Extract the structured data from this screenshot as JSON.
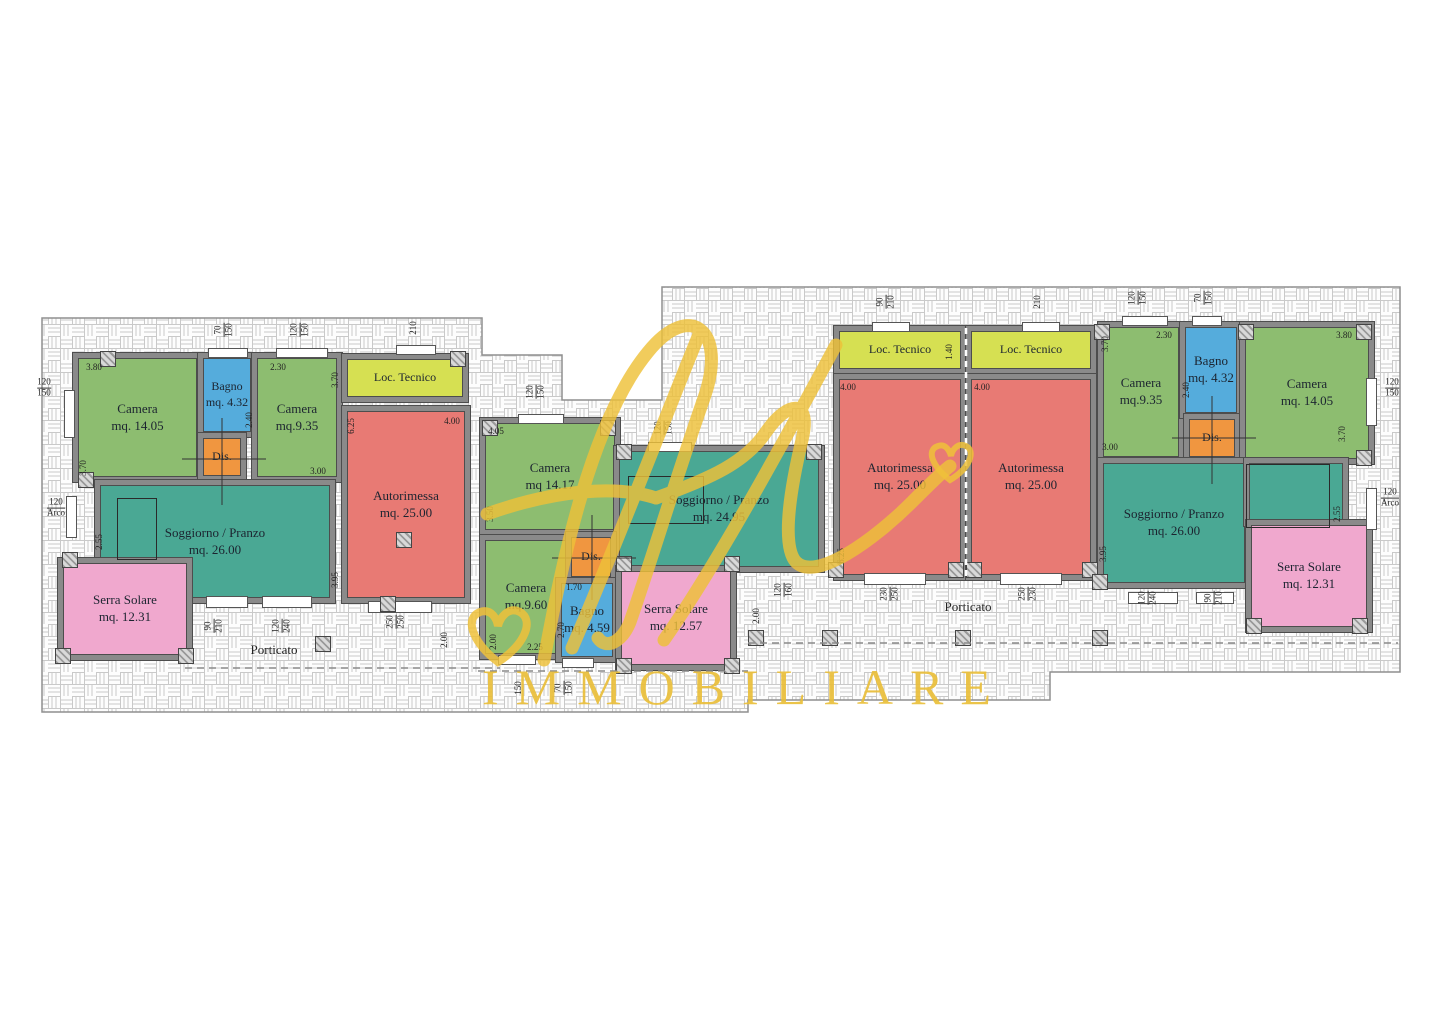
{
  "watermark": {
    "script": "fl",
    "brand": "IMMOBILIARE",
    "gold": "#eabf3a"
  },
  "palette": {
    "wall": "#8a8a8a",
    "wall_edge": "#4d4d4d",
    "camera_green": "#8dbd70",
    "bagno_blue": "#55acdc",
    "dis_orange": "#f09640",
    "loc_tecnico_yellow": "#d6e052",
    "autorimessa_red": "#e87a74",
    "soggiorno_teal": "#4aa894",
    "serra_pink": "#f0a8ce",
    "paving_line": "#c9c9c9",
    "dim_text": "#222222"
  },
  "floorplan": {
    "rooms": [
      {
        "id": "camera-a1",
        "c": "camera_green",
        "x": 73,
        "y": 353,
        "w": 129,
        "h": 129,
        "label": [
          "Camera",
          "mq. 14.05"
        ]
      },
      {
        "id": "bagno-a",
        "c": "bagno_blue",
        "x": 198,
        "y": 353,
        "w": 58,
        "h": 84,
        "label": [
          "Bagno",
          "mq. 4.32"
        ]
      },
      {
        "id": "camera-a2",
        "c": "camera_green",
        "x": 252,
        "y": 353,
        "w": 90,
        "h": 129,
        "label": [
          "Camera",
          "mq.9.35"
        ]
      },
      {
        "id": "dis-a",
        "c": "dis_orange",
        "x": 198,
        "y": 433,
        "w": 48,
        "h": 48,
        "label": [
          "Dis."
        ]
      },
      {
        "id": "loc-tecnico-a",
        "c": "loc_tecnico_yellow",
        "x": 342,
        "y": 354,
        "w": 126,
        "h": 48,
        "label": [
          "Loc. Tecnico"
        ]
      },
      {
        "id": "autorimessa-a",
        "c": "autorimessa_red",
        "x": 342,
        "y": 406,
        "w": 128,
        "h": 197,
        "label": [
          "Autorimessa",
          "mq. 25.00"
        ]
      },
      {
        "id": "soggiorno-a",
        "c": "soggiorno_teal",
        "x": 95,
        "y": 480,
        "w": 240,
        "h": 123,
        "label": [
          "Soggiorno / Pranzo",
          "mq. 26.00"
        ]
      },
      {
        "id": "serra-solare-a",
        "c": "serra_pink",
        "x": 58,
        "y": 558,
        "w": 134,
        "h": 102,
        "label": [
          "Serra Solare",
          "mq. 12.31"
        ]
      },
      {
        "id": "camera-b1",
        "c": "camera_green",
        "x": 480,
        "y": 418,
        "w": 140,
        "h": 117,
        "label": [
          "Camera",
          "mq 14.17"
        ]
      },
      {
        "id": "camera-b2",
        "c": "camera_green",
        "x": 480,
        "y": 535,
        "w": 92,
        "h": 124,
        "label": [
          "Camera",
          "mq.9.60"
        ]
      },
      {
        "id": "soggiorno-b",
        "c": "soggiorno_teal",
        "x": 614,
        "y": 446,
        "w": 210,
        "h": 126,
        "label": [
          "Soggiorno / Pranzo",
          "mq. 24.95"
        ]
      },
      {
        "id": "dis-b",
        "c": "dis_orange",
        "x": 566,
        "y": 532,
        "w": 50,
        "h": 50,
        "label": [
          "Dis."
        ]
      },
      {
        "id": "bagno-b",
        "c": "bagno_blue",
        "x": 556,
        "y": 578,
        "w": 62,
        "h": 84,
        "label": [
          "Bagno",
          "mq. 4.59"
        ]
      },
      {
        "id": "serra-solare-b",
        "c": "serra_pink",
        "x": 616,
        "y": 566,
        "w": 120,
        "h": 104,
        "label": [
          "Serra Solare",
          "mq. 12.57"
        ]
      },
      {
        "id": "loc-tecnico-c",
        "c": "loc_tecnico_yellow",
        "x": 834,
        "y": 326,
        "w": 132,
        "h": 48,
        "label": [
          "Loc. Tecnico"
        ]
      },
      {
        "id": "loc-tecnico-d",
        "c": "loc_tecnico_yellow",
        "x": 966,
        "y": 326,
        "w": 130,
        "h": 48,
        "label": [
          "Loc. Tecnico"
        ]
      },
      {
        "id": "autorimessa-c",
        "c": "autorimessa_red",
        "x": 834,
        "y": 374,
        "w": 132,
        "h": 206,
        "label": [
          "Autorimessa",
          "mq. 25.00"
        ]
      },
      {
        "id": "autorimessa-d",
        "c": "autorimessa_red",
        "x": 966,
        "y": 374,
        "w": 130,
        "h": 206,
        "label": [
          "Autorimessa",
          "mq. 25.00"
        ]
      },
      {
        "id": "camera-d1",
        "c": "camera_green",
        "x": 1098,
        "y": 322,
        "w": 86,
        "h": 140,
        "label": [
          "Camera",
          "mq.9.35"
        ]
      },
      {
        "id": "bagno-d",
        "c": "bagno_blue",
        "x": 1180,
        "y": 322,
        "w": 62,
        "h": 96,
        "label": [
          "Bagno",
          "mq. 4.32"
        ]
      },
      {
        "id": "dis-d",
        "c": "dis_orange",
        "x": 1184,
        "y": 414,
        "w": 56,
        "h": 48,
        "label": [
          "Dis."
        ]
      },
      {
        "id": "camera-d2",
        "c": "camera_green",
        "x": 1240,
        "y": 322,
        "w": 134,
        "h": 142,
        "label": [
          "Camera",
          "mq. 14.05"
        ]
      },
      {
        "id": "soggiorno-d",
        "c": "soggiorno_teal",
        "x": 1098,
        "y": 458,
        "w": 152,
        "h": 130,
        "label": [
          "Soggiorno / Pranzo",
          "mq. 26.00"
        ]
      },
      {
        "id": "soggiorno-d-ext",
        "c": "soggiorno_teal",
        "x": 1244,
        "y": 458,
        "w": 104,
        "h": 68,
        "label": []
      },
      {
        "id": "serra-solare-d",
        "c": "serra_pink",
        "x": 1246,
        "y": 520,
        "w": 126,
        "h": 112,
        "label": [
          "Serra Solare",
          "mq. 12.31"
        ]
      }
    ],
    "dims": [
      {
        "n": "70",
        "d": "150",
        "x": 224,
        "y": 330,
        "r": 1
      },
      {
        "n": "120",
        "d": "150",
        "x": 300,
        "y": 330,
        "r": 1
      },
      {
        "t": "210",
        "x": 414,
        "y": 328,
        "r": 1
      },
      {
        "n": "120",
        "d": "150",
        "x": 44,
        "y": 388
      },
      {
        "t": "3.80",
        "x": 94,
        "y": 368
      },
      {
        "t": "3.70",
        "x": 84,
        "y": 468,
        "r": 1
      },
      {
        "t": "2.30",
        "x": 278,
        "y": 368
      },
      {
        "t": "3.70",
        "x": 336,
        "y": 380,
        "r": 1
      },
      {
        "t": "2.40",
        "x": 250,
        "y": 420,
        "r": 1
      },
      {
        "t": "3.00",
        "x": 318,
        "y": 472
      },
      {
        "t": "6.25",
        "x": 352,
        "y": 426,
        "r": 1
      },
      {
        "t": "4.00",
        "x": 452,
        "y": 422
      },
      {
        "n": "120",
        "d": "Arco",
        "x": 56,
        "y": 508
      },
      {
        "t": "2.55",
        "x": 100,
        "y": 542,
        "r": 1
      },
      {
        "t": "3.95",
        "x": 336,
        "y": 580,
        "r": 1
      },
      {
        "n": "90",
        "d": "210",
        "x": 214,
        "y": 626,
        "r": 1
      },
      {
        "n": "120",
        "d": "240",
        "x": 282,
        "y": 626,
        "r": 1
      },
      {
        "n": "250",
        "d": "250",
        "x": 396,
        "y": 622,
        "r": 1
      },
      {
        "t": "2.00",
        "x": 445,
        "y": 640,
        "r": 1
      },
      {
        "t": "2.00",
        "x": 494,
        "y": 642,
        "r": 1
      },
      {
        "t": "150",
        "x": 519,
        "y": 688,
        "r": 1
      },
      {
        "n": "70",
        "d": "150",
        "x": 564,
        "y": 688,
        "r": 1
      },
      {
        "n": "120",
        "d": "150",
        "x": 536,
        "y": 392,
        "r": 1
      },
      {
        "t": "4.05",
        "x": 496,
        "y": 432
      },
      {
        "t": "3.50",
        "x": 491,
        "y": 514,
        "r": 1
      },
      {
        "n": "120",
        "d": "150",
        "x": 664,
        "y": 428,
        "r": 1
      },
      {
        "t": "1.70",
        "x": 574,
        "y": 588
      },
      {
        "t": "2.70",
        "x": 562,
        "y": 630,
        "r": 1
      },
      {
        "t": "2.25",
        "x": 535,
        "y": 648
      },
      {
        "n": "120",
        "d": "160",
        "x": 784,
        "y": 590,
        "r": 1
      },
      {
        "t": "2.00",
        "x": 757,
        "y": 616,
        "r": 1
      },
      {
        "n": "90",
        "d": "210",
        "x": 886,
        "y": 302,
        "r": 1
      },
      {
        "t": "210",
        "x": 1038,
        "y": 302,
        "r": 1
      },
      {
        "t": "1.40",
        "x": 950,
        "y": 352,
        "r": 1
      },
      {
        "t": "4.00",
        "x": 848,
        "y": 388
      },
      {
        "t": "4.00",
        "x": 982,
        "y": 388
      },
      {
        "t": "6.25",
        "x": 842,
        "y": 556,
        "r": 1
      },
      {
        "n": "120",
        "d": "150",
        "x": 1138,
        "y": 298,
        "r": 1
      },
      {
        "n": "70",
        "d": "150",
        "x": 1204,
        "y": 298,
        "r": 1
      },
      {
        "t": "3.70",
        "x": 1106,
        "y": 344,
        "r": 1
      },
      {
        "t": "2.30",
        "x": 1164,
        "y": 336
      },
      {
        "t": "3.80",
        "x": 1344,
        "y": 336
      },
      {
        "t": "2.40",
        "x": 1187,
        "y": 390,
        "r": 1
      },
      {
        "t": "3.00",
        "x": 1110,
        "y": 448
      },
      {
        "t": "3.70",
        "x": 1343,
        "y": 434,
        "r": 1
      },
      {
        "n": "120",
        "d": "150",
        "x": 1392,
        "y": 388
      },
      {
        "n": "120",
        "d": "Arco",
        "x": 1390,
        "y": 498
      },
      {
        "t": "2.55",
        "x": 1338,
        "y": 514,
        "r": 1
      },
      {
        "t": "3.95",
        "x": 1104,
        "y": 554,
        "r": 1
      },
      {
        "n": "230",
        "d": "250",
        "x": 890,
        "y": 594,
        "r": 1
      },
      {
        "n": "250",
        "d": "230",
        "x": 1028,
        "y": 594,
        "r": 1
      },
      {
        "n": "120",
        "d": "240",
        "x": 1148,
        "y": 598,
        "r": 1
      },
      {
        "n": "90",
        "d": "210",
        "x": 1214,
        "y": 598,
        "r": 1
      }
    ],
    "texts": [
      {
        "t": "Porticato",
        "x": 274,
        "y": 650
      },
      {
        "t": "Porticato",
        "x": 968,
        "y": 607
      }
    ],
    "openings": [
      [
        64,
        390,
        9,
        46
      ],
      [
        208,
        348,
        38,
        8
      ],
      [
        276,
        348,
        50,
        8
      ],
      [
        396,
        345,
        38,
        8
      ],
      [
        66,
        496,
        9,
        40
      ],
      [
        206,
        596,
        40,
        10
      ],
      [
        262,
        596,
        48,
        10
      ],
      [
        368,
        601,
        62,
        10
      ],
      [
        518,
        414,
        44,
        8
      ],
      [
        648,
        442,
        42,
        8
      ],
      [
        498,
        655,
        36,
        8
      ],
      [
        562,
        658,
        30,
        8
      ],
      [
        872,
        322,
        36,
        8
      ],
      [
        1022,
        322,
        36,
        8
      ],
      [
        1122,
        316,
        44,
        8
      ],
      [
        1192,
        316,
        28,
        8
      ],
      [
        864,
        573,
        60,
        10
      ],
      [
        1000,
        573,
        60,
        10
      ],
      [
        1366,
        378,
        9,
        46
      ],
      [
        1366,
        488,
        9,
        40
      ],
      [
        1128,
        592,
        48,
        10
      ],
      [
        1196,
        592,
        36,
        10
      ]
    ],
    "hatches": [
      [
        100,
        351
      ],
      [
        450,
        351
      ],
      [
        78,
        472
      ],
      [
        62,
        552
      ],
      [
        55,
        648
      ],
      [
        178,
        648
      ],
      [
        315,
        636
      ],
      [
        380,
        596
      ],
      [
        396,
        532
      ],
      [
        482,
        420
      ],
      [
        600,
        420
      ],
      [
        616,
        444
      ],
      [
        806,
        444
      ],
      [
        616,
        556
      ],
      [
        724,
        556
      ],
      [
        616,
        658
      ],
      [
        724,
        658
      ],
      [
        828,
        562
      ],
      [
        948,
        562
      ],
      [
        966,
        562
      ],
      [
        1082,
        562
      ],
      [
        1094,
        324
      ],
      [
        1238,
        324
      ],
      [
        1356,
        324
      ],
      [
        1092,
        574
      ],
      [
        1092,
        630
      ],
      [
        1356,
        450
      ],
      [
        1246,
        618
      ],
      [
        1352,
        618
      ],
      [
        748,
        630
      ],
      [
        822,
        630
      ],
      [
        955,
        630
      ]
    ],
    "nooks": [
      [
        117,
        498,
        38,
        60
      ],
      [
        628,
        476,
        74,
        46
      ],
      [
        1246,
        464,
        82,
        62
      ]
    ],
    "crosses": [
      [
        182,
        459,
        266,
        459
      ],
      [
        222,
        418,
        222,
        505
      ],
      [
        552,
        558,
        636,
        558
      ],
      [
        592,
        515,
        592,
        600
      ],
      [
        1172,
        438,
        1256,
        438
      ],
      [
        1212,
        396,
        1212,
        484
      ]
    ],
    "dashes": [
      [
        185,
        668,
        500,
        668
      ],
      [
        478,
        671,
        748,
        671
      ],
      [
        748,
        643,
        1398,
        643
      ]
    ],
    "white_dashes": [
      [
        966,
        328,
        966,
        578
      ]
    ]
  }
}
